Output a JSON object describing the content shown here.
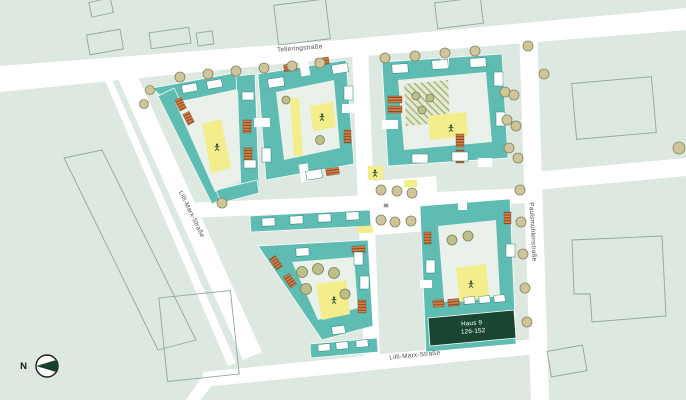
{
  "map": {
    "streets": {
      "top": "Telleringstraße",
      "left": "Lilli-Marx-Straße",
      "bottom": "Lilli-Marx-Straße",
      "right": "Paulsmühlenstraße"
    },
    "highlight_building": {
      "name": "Haus 9",
      "house_numbers": "126-152"
    },
    "compass": {
      "north_label": "N"
    },
    "icons": {
      "playground-icon": "stick-figure",
      "north-arrow-icon": "left-pointing-wedge-in-circle",
      "tree-icon": "circle",
      "plaza-symbol-icon": "small-gray-marker"
    },
    "colors": {
      "background": "#dde8e1",
      "street": "#ffffff",
      "building": "#5ebcb3",
      "courtyard": "#e9f1ea",
      "playground_yellow": "#f3ee8b",
      "balcony_orange": "#d2834c",
      "tree": "#cfc49a",
      "highlight_dark_green": "#1a4631",
      "context_outline": "#8fa89c"
    }
  }
}
